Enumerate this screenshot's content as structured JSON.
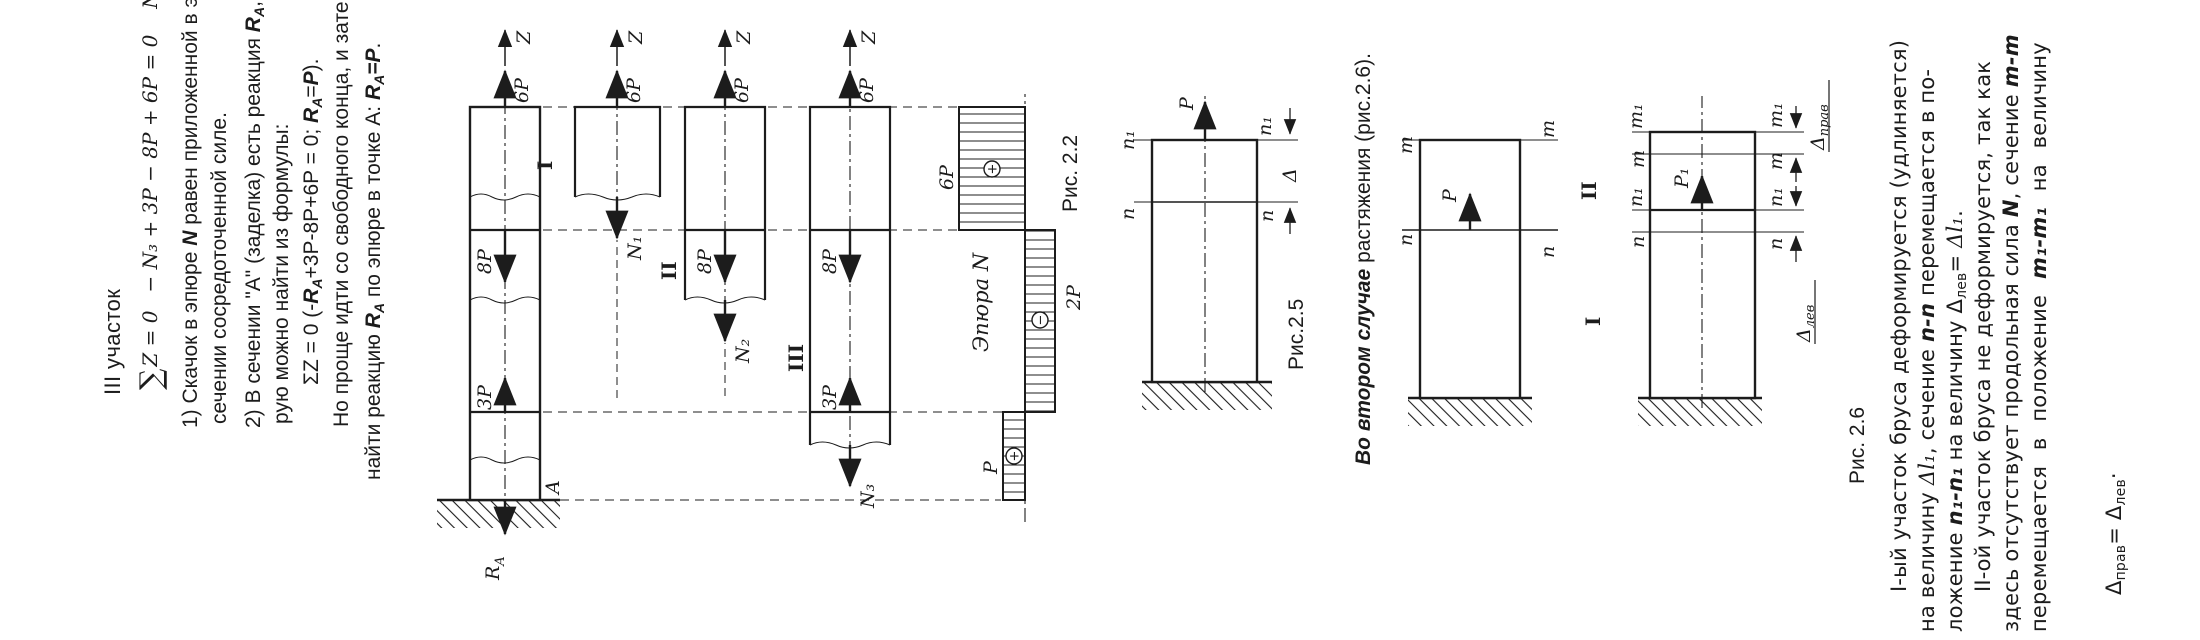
{
  "page": {
    "bg": "#ffffff",
    "ink": "#1c1c1c"
  },
  "sec3": {
    "heading": "III участок",
    "f1_sum": "∑",
    "f1_a": "Z = 0",
    "f1_b": "− N₃ + 3P − 8P + 6P = 0",
    "f1_c": "N₃ = P",
    "i1_l1a": "1) Скачок в эпюре ",
    "i1_l1b": "N",
    "i1_l1c": " равен приложенной в этом",
    "i1_l2": "сечении сосредоточенной силе.",
    "i2_l1a": "2) В сечении \"А\" (заделка) есть реакция ",
    "i2_l1b": "R",
    "i2_l1bsub": "A",
    "i2_l1c": ", кото-",
    "i2_l2": "рую можно найти из формулы:",
    "f2_a": "ΣZ = 0  (-",
    "f2_b": "R",
    "f2_bsub": "A",
    "f2_c": "+3P-8P+6P = 0; ",
    "f2_d": "R",
    "f2_dsub": "A",
    "f2_e": "=",
    "f2_f": "P",
    "f2_g": ").",
    "p3_l1": "Но проще идти со свободного конца, и затем",
    "p3_l2a": "найти реакцию ",
    "p3_l2b": "R",
    "p3_l2bsub": "A",
    "p3_l2c": " по эпюре в точке А: ",
    "p3_l2d": "R",
    "p3_l2dsub": "A",
    "p3_l2e": "=",
    "p3_l2f": "P",
    "p3_l2g": "."
  },
  "fig22": {
    "ra": "R",
    "ra_sub": "A",
    "a": "A",
    "p3": "3P",
    "p8": "8P",
    "p6": "6P",
    "z": "Z",
    "n1": "N₁",
    "n2": "N₂",
    "n3": "N₃",
    "sec1": "I",
    "sec2": "II",
    "sec3": "III",
    "ep_title": "Эпюра N",
    "ep_p": "P",
    "ep_2p": "2P",
    "ep_6p": "6P",
    "plus": "+",
    "minus": "−",
    "caption": "Рис. 2.2"
  },
  "fig25": {
    "p": "P",
    "n": "n",
    "n1": "n₁",
    "delta": "Δ",
    "caption": "Рис.2.5"
  },
  "mid": {
    "lead": "Во втором случае",
    "rest": " растяжения (рис.2.6)."
  },
  "fig26": {
    "m": "m",
    "n": "n",
    "m1": "m₁",
    "n1": "n₁",
    "p": "P",
    "p1": "P₁",
    "sec1": "I",
    "sec2": "II",
    "d": "Δ",
    "dlev": "лев",
    "dprav": "прав",
    "caption": "Рис. 2.6"
  },
  "right": {
    "r1": "I-ый участок бруса деформируется (удлиняется)",
    "r2a": "на величину ",
    "r2b": "Δl₁",
    "r2c": ", сечение ",
    "r2d": "n-n",
    "r2e": " перемещается в по-",
    "r3a": "ложение ",
    "r3b": "n₁-n₁",
    "r3c": " на величину ",
    "r3d": "Δ",
    "r3dsub": "лев",
    "r3e": "= ",
    "r3f": "Δl₁",
    "r3g": ".",
    "r4": "II-ой участок бруса не деформируется, так как",
    "r5a": "здесь отсутствует продольная сила ",
    "r5b": "N",
    "r5c": ", сечение ",
    "r5d": "m-m",
    "r6a": "перемещается в положение ",
    "r6b": "m₁-m₁",
    "r6c": " на величину",
    "r7a": "Δ",
    "r7asub": "прав",
    "r7b": "= ",
    "r7c": "Δ",
    "r7csub": "лев",
    "r7d": "·"
  }
}
